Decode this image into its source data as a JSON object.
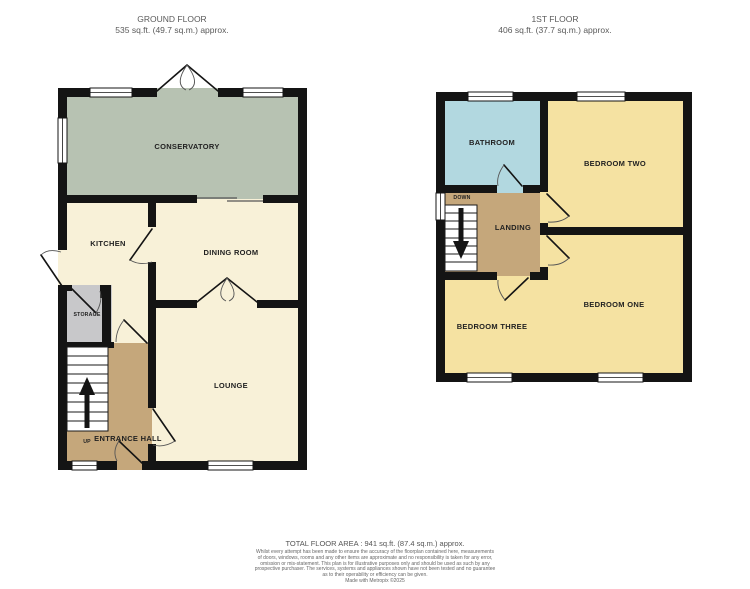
{
  "ground_floor": {
    "title": "GROUND FLOOR",
    "area": "535 sq.ft. (49.7 sq.m.) approx.",
    "rooms": {
      "conservatory": "CONSERVATORY",
      "kitchen": "KITCHEN",
      "dining": "DINING ROOM",
      "lounge": "LOUNGE",
      "entrance_hall": "ENTRANCE HALL",
      "storage": "STORAGE",
      "up": "UP"
    }
  },
  "first_floor": {
    "title": "1ST FLOOR",
    "area": "406 sq.ft. (37.7 sq.m.) approx.",
    "rooms": {
      "bathroom": "BATHROOM",
      "bedroom_two": "BEDROOM TWO",
      "bedroom_one": "BEDROOM ONE",
      "bedroom_three": "BEDROOM THREE",
      "landing": "LANDING",
      "down": "DOWN"
    }
  },
  "footer": {
    "total_area": "TOTAL FLOOR AREA : 941 sq.ft. (87.4 sq.m.) approx.",
    "disclaimer": [
      "Whilst every attempt has been made to ensure the accuracy of the floorplan contained here, measurements",
      "of doors, windows, rooms and any other items are approximate and no responsibility is taken for any error,",
      "omission or mis-statement. This plan is for illustrative purposes only and should be used as such by any",
      "prospective purchaser. The services, systems and appliances shown have not been tested and no guarantee",
      "as to their operability or efficiency can be given.",
      "Made with Metropix ©2025"
    ]
  },
  "colors": {
    "room_cream": "#f8f1d8",
    "conservatory_green": "#b7c2b2",
    "hall_tan": "#c5a77b",
    "storage_gray": "#c8c8ca",
    "bedroom_yellow": "#f5e2a2",
    "bathroom_blue": "#b2d8e0",
    "wall_black": "#141414",
    "window_white": "#ffffff",
    "label_text": "#222222",
    "header_text": "#5a5a5a"
  }
}
